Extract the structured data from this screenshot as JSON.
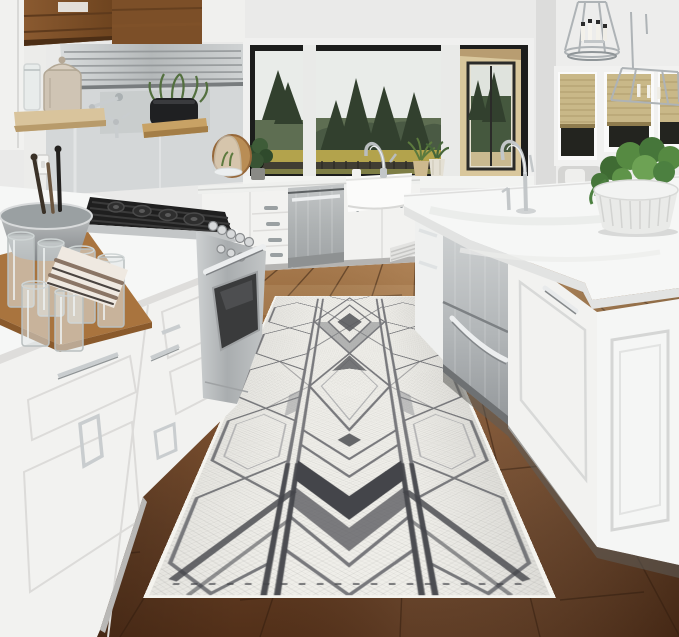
{
  "image_type": "product lifestyle photograph, no visible text",
  "scene": {
    "setting": "bright white kitchen with a long geometric runner rug laid on dark hardwood flooring between perimeter cabinets and a large island",
    "objects": [
      "white shaker cabinetry with chrome pulls",
      "stainless gas range with black cooktop grates",
      "wood range hood with stainless liner",
      "open wood shelf with glass jar and ceramic canister",
      "chrome wall-mounted pot filler",
      "black planter with greenery on small wood shelf",
      "black framed picture window with evergreen and meadow view",
      "white farmhouse apron sink with chrome gooseneck faucet",
      "stainless dishwasher",
      "kitchen island with quartz countertop, stainless apron sink and drawer unit",
      "island chrome gooseneck faucet with soap dispenser",
      "two chrome lantern pendant lights with candle bulbs",
      "windows with woven bamboo roman shades",
      "white fluted bowl with trailing green plant",
      "wood cutting board with drinking glasses, gray mixing bowl, striped towel",
      "potted plants on window sill",
      "glass cloche on round wood board",
      "geometric runner rug"
    ]
  },
  "palette": {
    "wall": "#eaeae9",
    "cabinetWhite": "#f2f2f0",
    "counterWhite": "#f6f7f6",
    "steel": "#c3c6c7",
    "steelDark": "#9ea2a4",
    "hoodWood": "#7c4f28",
    "shelfWood": "#8a5a30",
    "floorLight": "#ad7f52",
    "floorDark": "#533019",
    "rugBase": "#efeee9",
    "rugLine": "#6f7074",
    "rugDark": "#44454a",
    "treeGreen": "#32402e",
    "meadow": "#b3a34c",
    "sky": "#e9ece9",
    "shadeTan": "#c9b888",
    "plantGreen": "#4e7a3c"
  },
  "rug": {
    "type": "runner",
    "pattern": "art deco geometric: elongated hexagon side columns, nested diamond medallion, chevron feather bands with charcoal fills, double rail lines",
    "colors": {
      "base": "#efeee9",
      "lines": "#6f7074",
      "accent": "#44454a"
    },
    "texture": "flat-woven herringbone"
  },
  "window_view": {
    "elements": [
      "white overcast sky",
      "evergreen trees",
      "golden meadow",
      "black metal fence",
      "covered patio with tan wall"
    ]
  },
  "lighting": {
    "pendants": 2,
    "style": "chrome lantern with four candle bulbs"
  }
}
